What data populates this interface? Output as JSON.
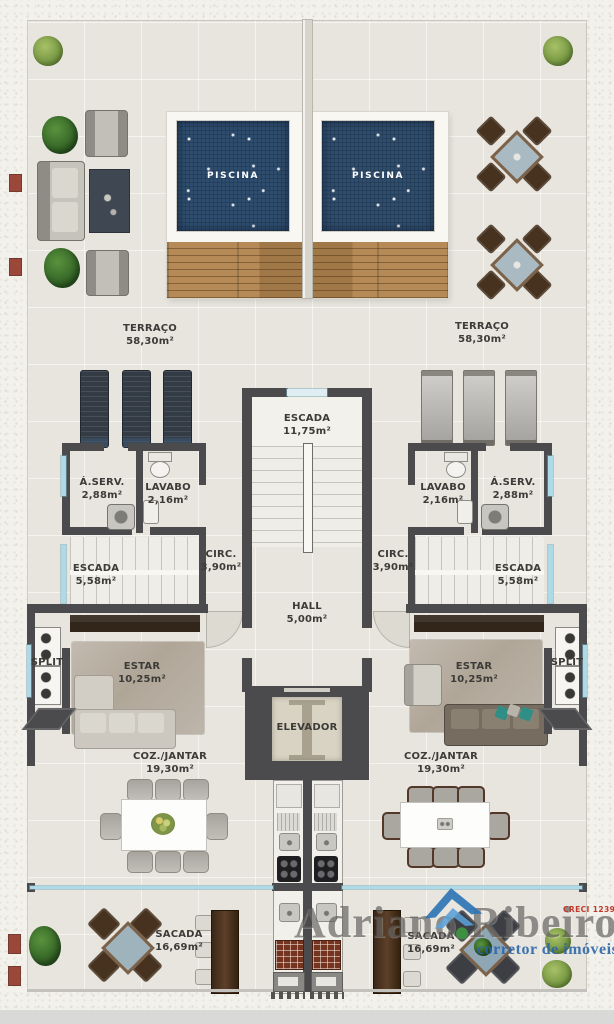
{
  "rooms": {
    "piscina": {
      "label": "PISCINA"
    },
    "terraco": {
      "label": "TERRAÇO",
      "area": "58,30m²"
    },
    "escada_social": {
      "label": "ESCADA",
      "area": "11,75m²"
    },
    "aserv": {
      "label": "Á.SERV.",
      "area": "2,88m²"
    },
    "lavabo": {
      "label": "LAVABO",
      "area": "2,16m²"
    },
    "escada_unidade": {
      "label": "ESCADA",
      "area": "5,58m²"
    },
    "circ": {
      "label": "CIRC.",
      "area": "3,90m²"
    },
    "hall": {
      "label": "HALL",
      "area": "5,00m²"
    },
    "split": {
      "label": "SPLIT"
    },
    "estar": {
      "label": "ESTAR",
      "area": "10,25m²"
    },
    "elevador": {
      "label": "ELEVADOR"
    },
    "coz_jantar": {
      "label": "COZ./JANTAR",
      "area": "19,30m²"
    },
    "sacada": {
      "label": "SACADA",
      "area": "16,69m²"
    }
  },
  "watermark": {
    "name": "Adriano Ribeiro",
    "tagline": "corretor de imóveis",
    "creci": "CRECI 12394"
  },
  "colors": {
    "wall": "#4b4b4d",
    "floor": "#e8e5de",
    "pool_water": "#2e4d6e",
    "wood_deck": "#ad8352",
    "glass": "#aed9e6",
    "watermark_blue": "#2f76b5",
    "creci_red": "#c0392b"
  }
}
